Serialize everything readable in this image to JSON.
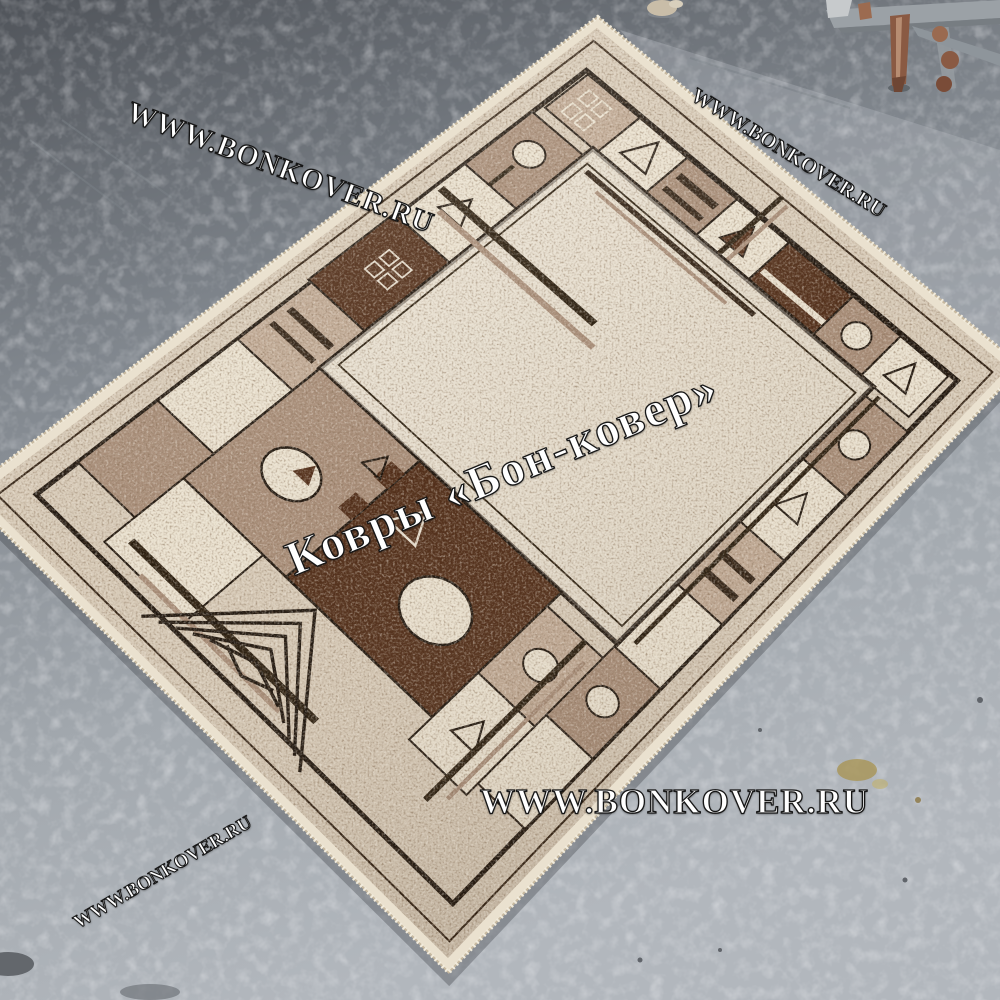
{
  "watermarks": {
    "top_left": {
      "text": "WWW.BONKOVER.RU"
    },
    "top_right": {
      "text": "WWW.BONKOVER.RU"
    },
    "center": {
      "text": "Ковры «Бон-ковер»"
    },
    "bottom": {
      "text": "WWW.BONKOVER.RU"
    },
    "bottom_left": {
      "text": "WWW.BONKOVER.RU"
    }
  },
  "palette": {
    "floor_dark": "#50545a",
    "floor_mid": "#80868d",
    "floor_light": "#b2b7bd",
    "rug_cream": "#eae1cf",
    "rug_beige": "#d7cab7",
    "rug_field": "#dcd2c0",
    "rug_taupe": "#a78c77",
    "rug_lightbrown": "#c0a994",
    "rug_darkbrown": "#4e2a15",
    "outline_black": "#191008",
    "watermark_fill": "#ffffff",
    "watermark_stroke": "#161616",
    "rust": "#8a5a43",
    "metal_gray": "#9ba1a6",
    "stain_yellow": "#a8934f"
  }
}
